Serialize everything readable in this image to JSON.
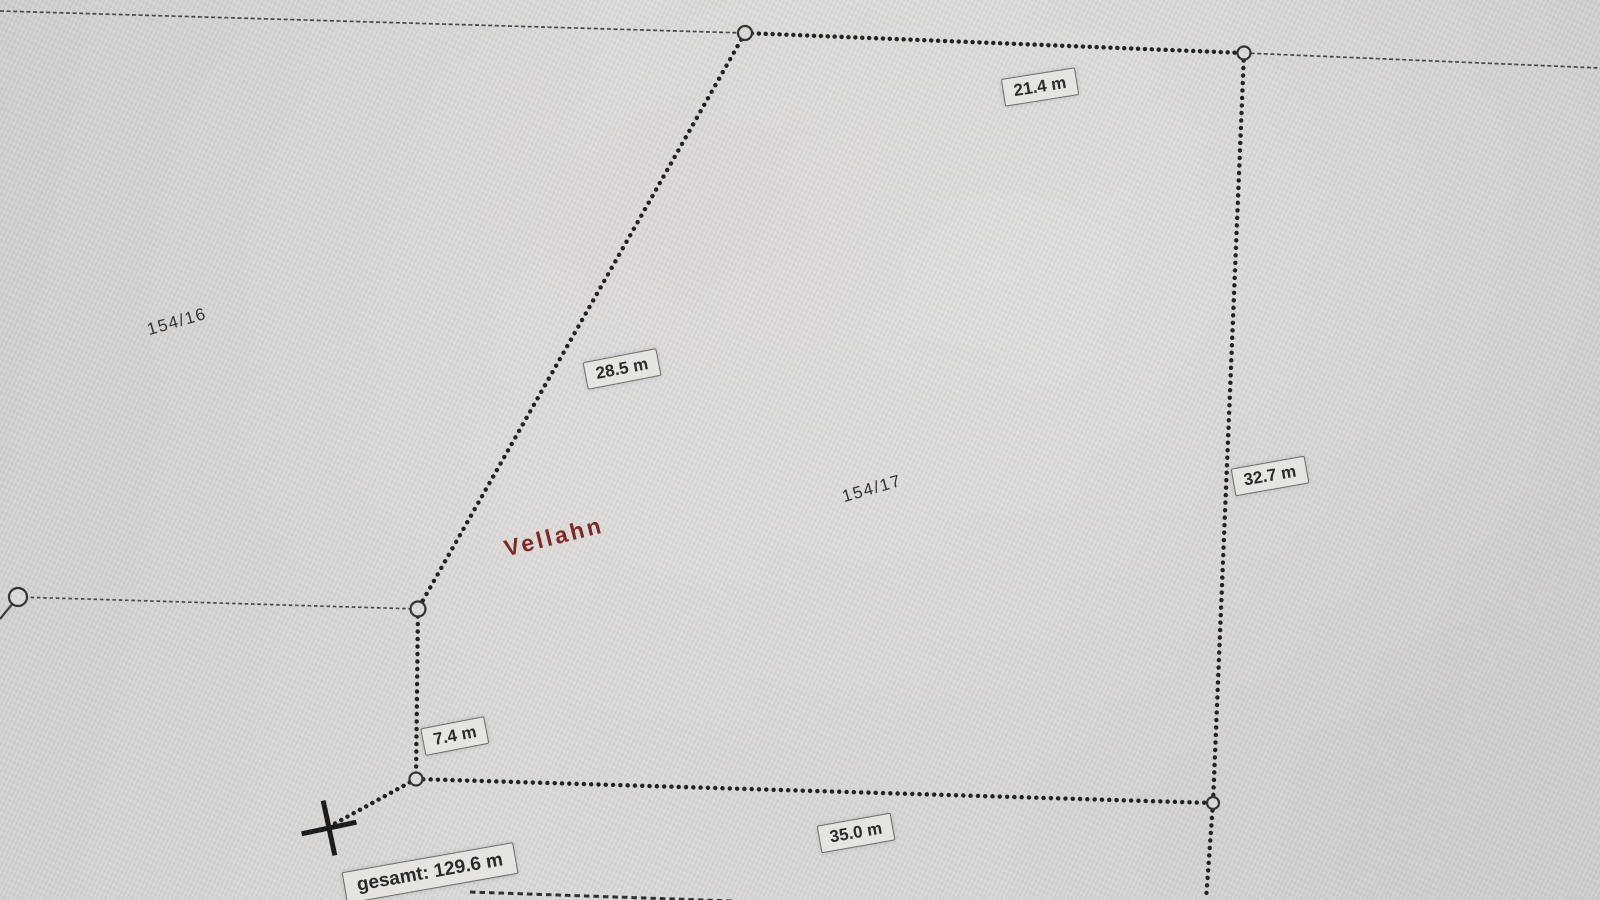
{
  "map": {
    "place_label": "Vellahn",
    "parcel_labels": {
      "left_parcel": "154/16",
      "right_parcel": "154/17"
    }
  },
  "measurement": {
    "segments": [
      {
        "length": "21.4 m"
      },
      {
        "length": "28.5 m"
      },
      {
        "length": "32.7 m"
      },
      {
        "length": "7.4 m"
      },
      {
        "length": "35.0 m"
      }
    ],
    "total": "gesamt: 129.6 m"
  },
  "colors": {
    "background": "#d9d8d6",
    "boundary_line": "#1d1d1d",
    "thin_line": "#444442",
    "label_box_background": "#e5e4e1",
    "label_box_border": "#6e6e6c",
    "label_text": "#2b2b29",
    "place_text": "#7c2824",
    "parcel_text": "#333336"
  }
}
